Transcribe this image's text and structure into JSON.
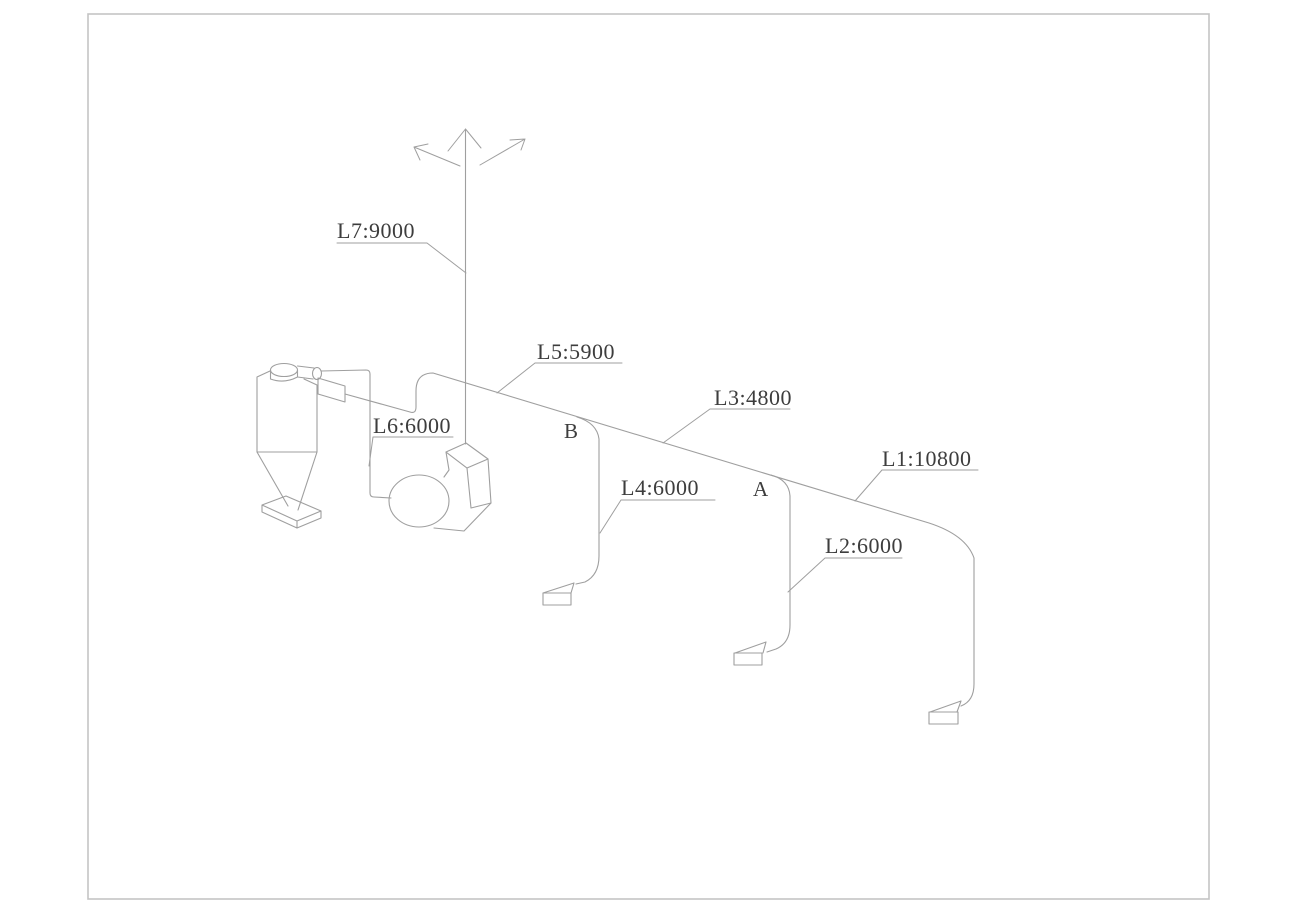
{
  "diagram": {
    "colors": {
      "line_color": "#9f9f9f",
      "text_color": "#3d3d3d",
      "border_color": "#c4c4c4",
      "bg_color": "#ffffff"
    },
    "labels": {
      "l1": "L1:10800",
      "l2": "L2:6000",
      "l3": "L3:4800",
      "l4": "L4:6000",
      "l5": "L5:5900",
      "l6": "L6:6000",
      "l7": "L7:9000"
    },
    "junctions": {
      "a": "A",
      "b": "B"
    }
  }
}
